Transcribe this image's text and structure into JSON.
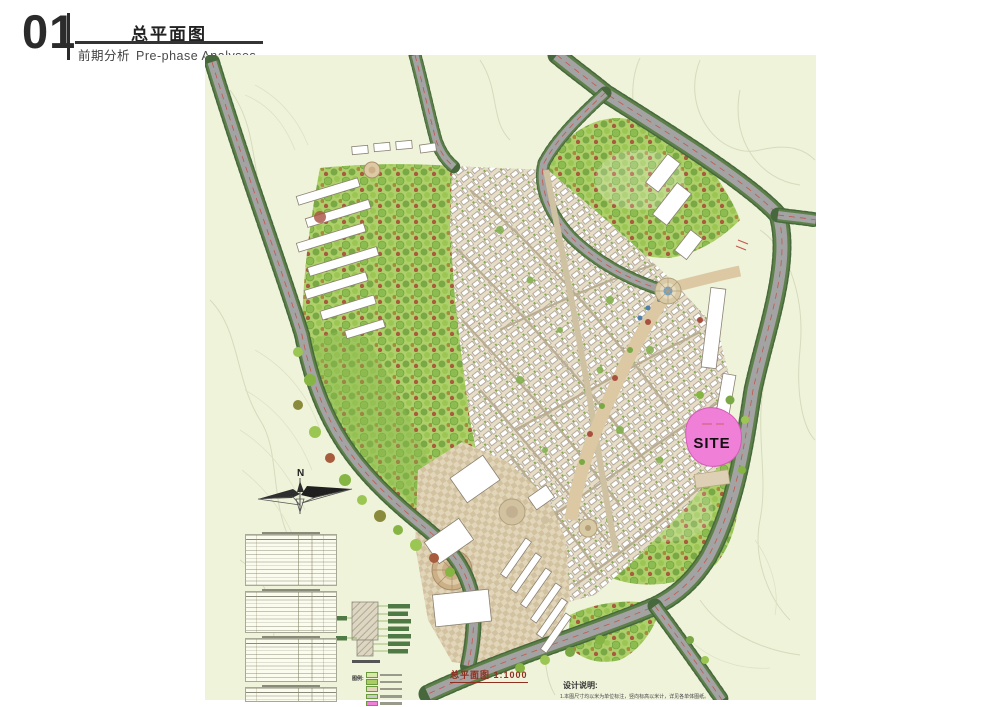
{
  "header": {
    "number": "01",
    "title": "总平面图",
    "subtitle_cn": "前期分析",
    "subtitle_en": "Pre-phase Analyses"
  },
  "map": {
    "compass_label": "N",
    "site_label": "SITE",
    "plan_caption": "总平面图 1:1000",
    "legend_title": "图例:",
    "notes_title": "设计说明:",
    "notes_line": "1.本图尺寸均以米为单位标注，竖向标高以米计，详见各单体图纸。",
    "colors": {
      "site_pink": "#ef7fd7",
      "road_gray": "#a3a3a3",
      "tree_edge_green": "#46683c",
      "park_green": "#aacd62",
      "map_background": "#eff3da",
      "caption_red": "#8e2f1f"
    }
  }
}
